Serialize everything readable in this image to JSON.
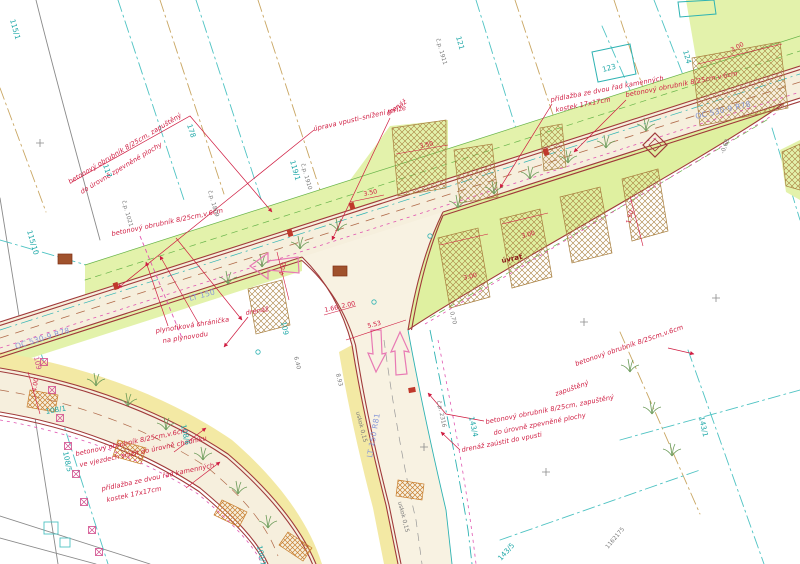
{
  "meta": {
    "drawing_type": "situační výkres / site plan",
    "language": "cs"
  },
  "colors": {
    "annotation_red": "#cf1b40",
    "curb_dark_red": "#a03a3a",
    "parcel_teal": "#1fa8a8",
    "boundary_tan": "#c9a662",
    "road_label_blue": "#8a9ad8",
    "utility_magenta": "#e055b0",
    "traffic_arrow_pink": "#e87ab4",
    "grass_green_fill": "#e3f2ab",
    "pavement_cream_fill": "#f6efdd",
    "sidewalk_yellow_fill": "#f3e9a4",
    "hatch_brown": "#a87f3f"
  },
  "texts": [
    {
      "n": "note-curb-nw-line1",
      "t": "betonový obrubník 8/25cm, zapuštěný",
      "x": 70,
      "y": 184,
      "r": -31,
      "c": "note"
    },
    {
      "n": "note-curb-nw-line2",
      "t": "do úrovně zpevněné plochy",
      "x": 82,
      "y": 194,
      "r": -31,
      "c": "note"
    },
    {
      "n": "note-inlet-adjust",
      "t": "úprava vpusti–snížení mříže",
      "x": 314,
      "y": 131,
      "r": -13,
      "c": "note"
    },
    {
      "n": "note-drain-north",
      "t": "drenáž",
      "x": 388,
      "y": 116,
      "r": -35,
      "c": "note"
    },
    {
      "n": "note-paving-north-line1",
      "t": "přídlažba ze dvou řad kamenných",
      "x": 551,
      "y": 102,
      "r": -11,
      "c": "note"
    },
    {
      "n": "note-paving-north-line2",
      "t": "kostek 17x17cm",
      "x": 556,
      "y": 112,
      "r": -11,
      "c": "note"
    },
    {
      "n": "note-curb-ne",
      "t": "betonový obrubník 8/25cm,v.6cm",
      "x": 626,
      "y": 97,
      "r": -11,
      "c": "note"
    },
    {
      "n": "note-curb-west",
      "t": "betonový obrubník 8/25cm,v.6cm",
      "x": 112,
      "y": 236,
      "r": -12,
      "c": "note"
    },
    {
      "n": "note-gas-sleeve-line1",
      "t": "plynofiková chránička",
      "x": 156,
      "y": 333,
      "r": -9,
      "c": "note"
    },
    {
      "n": "note-gas-sleeve-line2",
      "t": "na plynovodu",
      "x": 163,
      "y": 343,
      "r": -9,
      "c": "note"
    },
    {
      "n": "note-drain-west",
      "t": "drenáž",
      "x": 246,
      "y": 315,
      "r": -10,
      "c": "note"
    },
    {
      "n": "note-curb-sw-line1",
      "t": "betonový obrubník 8/25cm,v.6cm",
      "x": 76,
      "y": 456,
      "r": -12,
      "c": "note"
    },
    {
      "n": "note-curb-sw-line2",
      "t": "ve vjezdech snížit do úrovně chodníku",
      "x": 80,
      "y": 467,
      "r": -12,
      "c": "note"
    },
    {
      "n": "note-paving-south-line1",
      "t": "přídlažba ze dvou řad kamenných",
      "x": 102,
      "y": 491,
      "r": -12,
      "c": "note"
    },
    {
      "n": "note-paving-south-line2",
      "t": "kostek 17x17cm",
      "x": 107,
      "y": 502,
      "r": -12,
      "c": "note"
    },
    {
      "n": "note-curb-se-line1",
      "t": "betonový obrubník 8/25cm, zapuštěný",
      "x": 486,
      "y": 424,
      "r": -11,
      "c": "note"
    },
    {
      "n": "note-curb-se-line2",
      "t": "do úrovně zpevněné plochy",
      "x": 494,
      "y": 435,
      "r": -11,
      "c": "note"
    },
    {
      "n": "note-drain-to-inlet",
      "t": "drenáž zaústit do vpusti",
      "x": 462,
      "y": 452,
      "r": -11,
      "c": "note"
    },
    {
      "n": "note-curb-east-line1",
      "t": "betonový obrubník 8/25cm,v.6cm",
      "x": 576,
      "y": 366,
      "r": -19,
      "c": "note"
    },
    {
      "n": "note-curb-east-line2",
      "t": "zapuštěný",
      "x": 556,
      "y": 396,
      "r": -19,
      "c": "note"
    },
    {
      "n": "label-uvrat",
      "t": "úvrať",
      "x": 502,
      "y": 263,
      "r": -12,
      "c": "struct"
    },
    {
      "n": "dim-3-50-a",
      "t": "3.50",
      "x": 420,
      "y": 148,
      "r": -12,
      "c": "dim"
    },
    {
      "n": "dim-3-50-b",
      "t": "3.50",
      "x": 364,
      "y": 196,
      "r": -12,
      "c": "dim"
    },
    {
      "n": "dim-3-00-a",
      "t": "3.00",
      "x": 522,
      "y": 238,
      "r": -14,
      "c": "dim"
    },
    {
      "n": "dim-3-00-b",
      "t": "3.00",
      "x": 464,
      "y": 280,
      "r": -14,
      "c": "dim"
    },
    {
      "n": "dim-1-50",
      "t": "1.50",
      "x": 630,
      "y": 224,
      "r": -75,
      "c": "dim"
    },
    {
      "n": "dim-3-00-c",
      "t": "3.00",
      "x": 732,
      "y": 52,
      "r": -28,
      "c": "dim"
    },
    {
      "n": "dim-5-53",
      "t": "5.53",
      "x": 368,
      "y": 328,
      "r": -14,
      "c": "dim"
    },
    {
      "n": "dim-4-00-a",
      "t": "4.00",
      "x": 283,
      "y": 276,
      "r": -76,
      "c": "dim"
    },
    {
      "n": "dim-1-66",
      "t": "1.66",
      "x": 325,
      "y": 312,
      "r": -12,
      "c": "dim"
    },
    {
      "n": "dim-2-00",
      "t": "2.00",
      "x": 342,
      "y": 308,
      "r": -12,
      "c": "dim"
    },
    {
      "n": "dim-4-00-b",
      "t": "4.00",
      "x": 36,
      "y": 392,
      "r": -80,
      "c": "dim"
    },
    {
      "n": "road-class-east",
      "t": "OC 530-9 R78",
      "x": 696,
      "y": 119,
      "r": -13,
      "c": "road"
    },
    {
      "n": "road-class-west",
      "t": "OC 530-9 R78",
      "x": 16,
      "y": 349,
      "r": -17,
      "c": "road"
    },
    {
      "n": "road-class-lt150",
      "t": "LT 150",
      "x": 190,
      "y": 301,
      "r": -15,
      "c": "road"
    },
    {
      "n": "road-class-lt150-r81",
      "t": "LT 150 R81",
      "x": 372,
      "y": 458,
      "r": -80,
      "c": "road"
    },
    {
      "n": "parcel-115-1",
      "t": "115/1",
      "x": 10,
      "y": 20,
      "r": 74,
      "c": "parcel"
    },
    {
      "n": "parcel-115-10",
      "t": "115/10",
      "x": 27,
      "y": 231,
      "r": 74,
      "c": "parcel"
    },
    {
      "n": "parcel-117",
      "t": "117",
      "x": 103,
      "y": 165,
      "r": 72,
      "c": "parcel"
    },
    {
      "n": "parcel-178",
      "t": "178",
      "x": 187,
      "y": 125,
      "r": 72,
      "c": "parcel"
    },
    {
      "n": "parcel-119-1",
      "t": "119/1",
      "x": 290,
      "y": 161,
      "r": 74,
      "c": "parcel"
    },
    {
      "n": "parcel-cp-1910",
      "t": "č.p. 1910",
      "x": 301,
      "y": 164,
      "r": 74,
      "c": "gray"
    },
    {
      "n": "parcel-cp-1809",
      "t": "č.p. 1809",
      "x": 208,
      "y": 191,
      "r": 74,
      "c": "gray"
    },
    {
      "n": "parcel-cp-1911",
      "t": "č.p. 1911",
      "x": 436,
      "y": 39,
      "r": 74,
      "c": "gray"
    },
    {
      "n": "parcel-121",
      "t": "121",
      "x": 456,
      "y": 37,
      "r": 74,
      "c": "parcel"
    },
    {
      "n": "parcel-123",
      "t": "123",
      "x": 603,
      "y": 72,
      "r": -15,
      "c": "parcel"
    },
    {
      "n": "parcel-124",
      "t": "124",
      "x": 683,
      "y": 51,
      "r": 74,
      "c": "parcel"
    },
    {
      "n": "parcel-108-1",
      "t": "108/1",
      "x": 46,
      "y": 414,
      "r": -10,
      "c": "parcel"
    },
    {
      "n": "parcel-108-5",
      "t": "108/5",
      "x": 63,
      "y": 452,
      "r": 78,
      "c": "parcel"
    },
    {
      "n": "parcel-108-6",
      "t": "108/6",
      "x": 181,
      "y": 425,
      "r": 78,
      "c": "parcel"
    },
    {
      "n": "parcel-109-a",
      "t": "109",
      "x": 34,
      "y": 357,
      "r": 78,
      "c": "miscred"
    },
    {
      "n": "parcel-109-b",
      "t": "109",
      "x": 281,
      "y": 322,
      "r": 78,
      "c": "parcel"
    },
    {
      "n": "parcel-143-4",
      "t": "143/4",
      "x": 469,
      "y": 417,
      "r": 78,
      "c": "parcel"
    },
    {
      "n": "parcel-cp-2316",
      "t": "č.p. 2316",
      "x": 437,
      "y": 401,
      "r": 78,
      "c": "gray"
    },
    {
      "n": "parcel-143-1",
      "t": "143/1",
      "x": 699,
      "y": 417,
      "r": 78,
      "c": "parcel"
    },
    {
      "n": "parcel-143-5",
      "t": "143/5",
      "x": 501,
      "y": 561,
      "r": -48,
      "c": "parcel"
    },
    {
      "n": "parcel-100-1",
      "t": "100/1",
      "x": 257,
      "y": 546,
      "r": 78,
      "c": "parcel"
    },
    {
      "n": "parcel-cp-1021",
      "t": "č.p. 1021",
      "x": 122,
      "y": 201,
      "r": 74,
      "c": "gray"
    },
    {
      "n": "survey-coordinate",
      "t": "1162175",
      "x": 608,
      "y": 549,
      "r": -50,
      "c": "gray"
    },
    {
      "n": "elev-6-40",
      "t": "6.40",
      "x": 294,
      "y": 357,
      "r": 76,
      "c": "gray"
    },
    {
      "n": "elev-8-93",
      "t": "8.93",
      "x": 336,
      "y": 374,
      "r": 76,
      "c": "gray"
    },
    {
      "n": "elev-uskok-a",
      "t": "uskok 0,15",
      "x": 356,
      "y": 412,
      "r": 76,
      "c": "gray"
    },
    {
      "n": "elev-uskok-b",
      "t": "uskok 0,15",
      "x": 398,
      "y": 502,
      "r": 76,
      "c": "gray"
    },
    {
      "n": "elev-minus-0-68",
      "t": "-0,68",
      "x": 724,
      "y": 154,
      "r": -70,
      "c": "gray"
    },
    {
      "n": "elev-0-70",
      "t": "0,70",
      "x": 450,
      "y": 312,
      "r": 76,
      "c": "gray"
    }
  ]
}
